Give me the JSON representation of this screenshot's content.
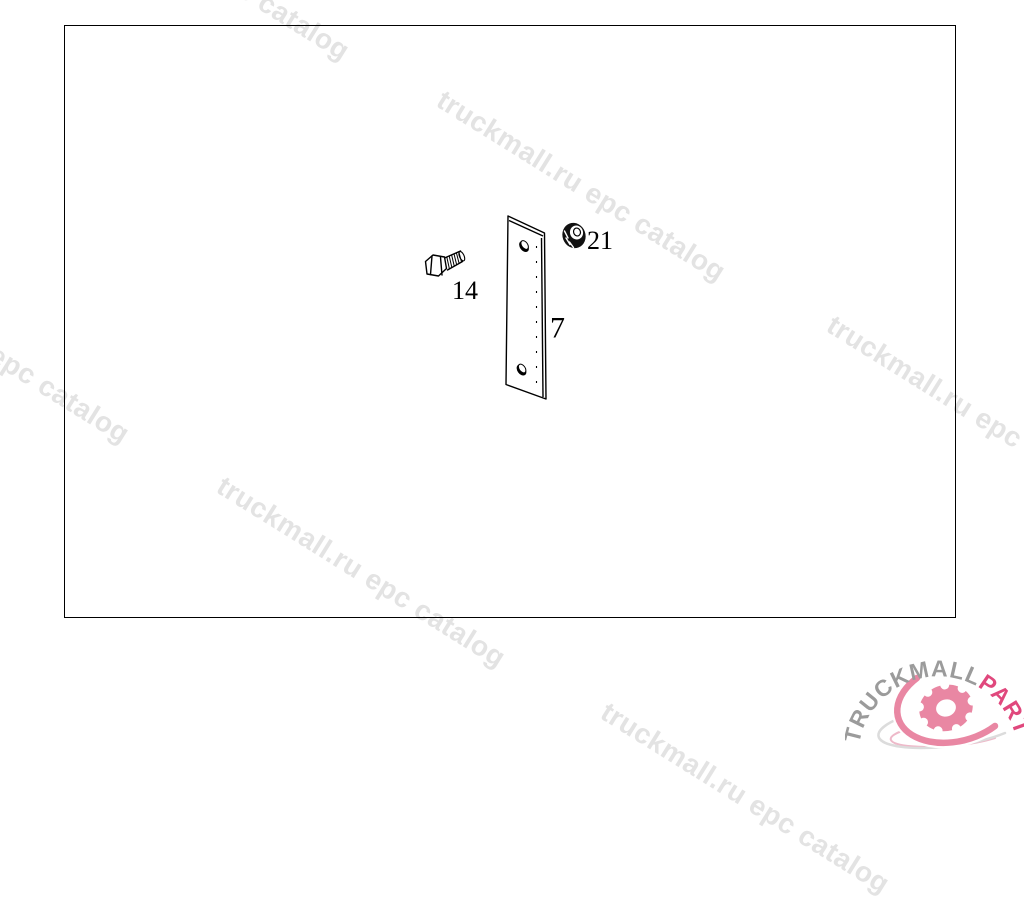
{
  "watermark": {
    "text": "truckmall.ru epc catalog",
    "color": "#e3e3e3"
  },
  "parts": {
    "plate": {
      "label": "7",
      "name": "mounting plate"
    },
    "bolt": {
      "label": "14",
      "name": "hex bolt"
    },
    "nut": {
      "label": "21",
      "name": "hex nut"
    }
  },
  "logo": {
    "brand_gray": "TRUCKMALL",
    "brand_pink": "PARTS",
    "colors": {
      "gray": "#9b9b9b",
      "pink": "#e0487d",
      "gear": "#e987a3",
      "swoosh_gray": "#dcdcdc",
      "swoosh_pink": "#eeb9c9"
    }
  }
}
